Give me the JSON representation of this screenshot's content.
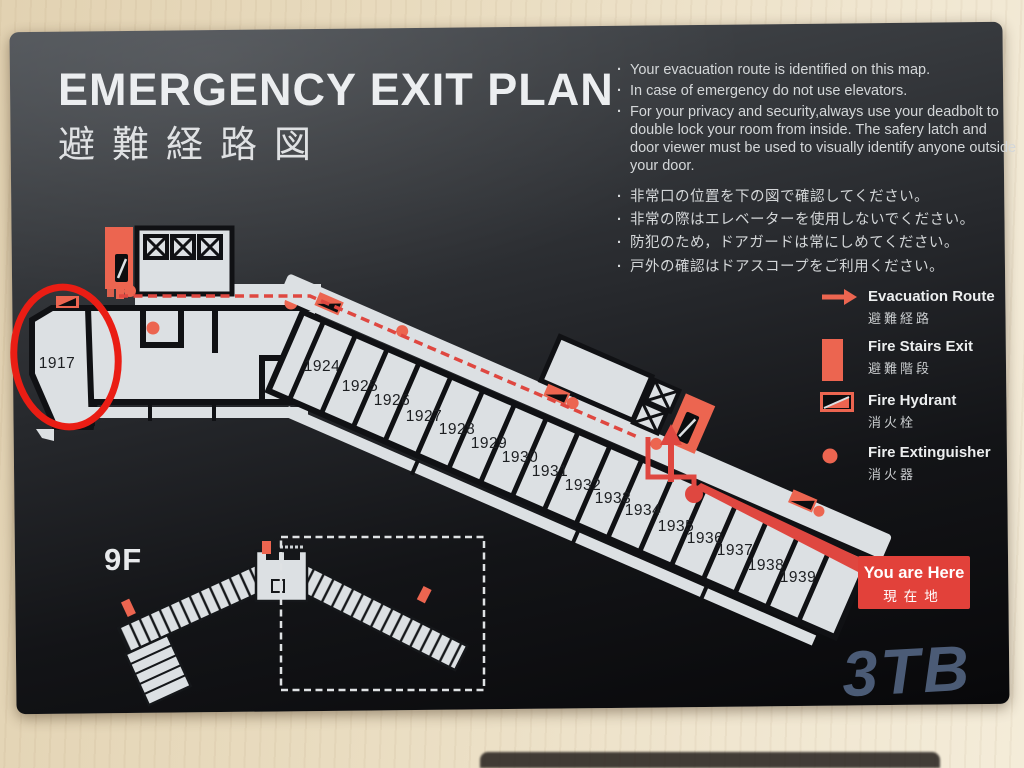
{
  "sign": {
    "title_en": "EMERGENCY EXIT PLAN",
    "title_ja": "避難経路図",
    "notes_en": [
      "Your evacuation route is identified on this map.",
      "In case of emergency do not use elevators.",
      "For your privacy and security,always use your deadbolt to double lock your room from inside. The safery latch and door viewer must be used to visually identify anyone outside your door."
    ],
    "notes_ja": [
      "非常口の位置を下の図で確認してください。",
      "非常の際はエレベーターを使用しないでください。",
      "防犯のため，ドアガードは常にしめてください。",
      "戸外の確認はドアスコープをご利用ください。"
    ],
    "legend": {
      "evacuation_route": {
        "en": "Evacuation Route",
        "ja": "避難経路"
      },
      "fire_stairs_exit": {
        "en": "Fire Stairs Exit",
        "ja": "避難階段"
      },
      "fire_hydrant": {
        "en": "Fire Hydrant",
        "ja": "消火栓"
      },
      "fire_extinguisher": {
        "en": "Fire Extinguisher",
        "ja": "消火器"
      }
    },
    "you_are_here": {
      "en": "You are Here",
      "ja": "現在地"
    },
    "floor_label": "9F",
    "rooms": [
      {
        "number": "1917",
        "x": 57,
        "y": 364
      },
      {
        "number": "1924",
        "x": 322,
        "y": 367
      },
      {
        "number": "1925",
        "x": 360,
        "y": 387
      },
      {
        "number": "1926",
        "x": 392,
        "y": 401
      },
      {
        "number": "1927",
        "x": 424,
        "y": 417
      },
      {
        "number": "1928",
        "x": 457,
        "y": 430
      },
      {
        "number": "1929",
        "x": 489,
        "y": 444
      },
      {
        "number": "1930",
        "x": 520,
        "y": 458
      },
      {
        "number": "1931",
        "x": 550,
        "y": 472
      },
      {
        "number": "1932",
        "x": 583,
        "y": 486
      },
      {
        "number": "1933",
        "x": 613,
        "y": 499
      },
      {
        "number": "1934",
        "x": 643,
        "y": 511
      },
      {
        "number": "1935",
        "x": 676,
        "y": 527
      },
      {
        "number": "1936",
        "x": 705,
        "y": 539
      },
      {
        "number": "1937",
        "x": 735,
        "y": 551
      },
      {
        "number": "1938",
        "x": 766,
        "y": 566
      },
      {
        "number": "1939",
        "x": 798,
        "y": 578
      }
    ],
    "colors": {
      "accent_salmon": "#ec6550",
      "route_red": "#df4740",
      "annotation_circle_red": "#ea1d14",
      "plan_white": "#dce0e3",
      "you_are_here_red": "#e2413a"
    }
  },
  "photo": {
    "watermark": "3TB"
  }
}
